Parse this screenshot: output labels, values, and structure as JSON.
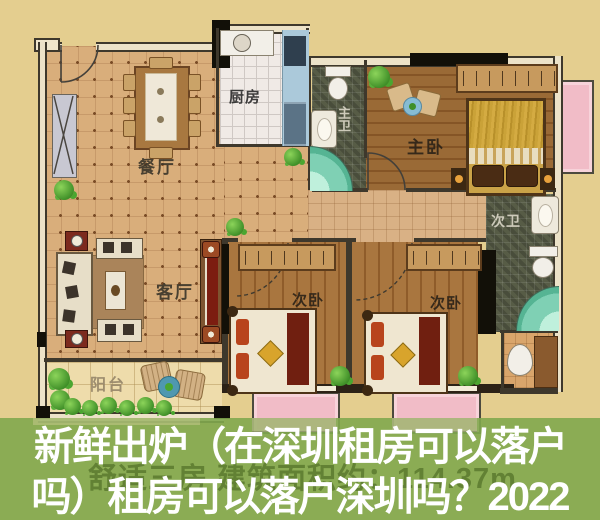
{
  "cover": {
    "title_line1": "新鲜出炉（在深圳租房可以落户",
    "title_line2": "吗）租房可以落户深圳吗？2022",
    "watermark": "舒适三房 建筑面积约：114.37m",
    "overlay_color": "#8fae58",
    "title_color": "#ffffff"
  },
  "floor_plan": {
    "rooms": {
      "dining": "餐厅",
      "kitchen": "厨房",
      "master_bath": "主卫",
      "master_bedroom": "主卧",
      "second_bath": "次卫",
      "living": "客厅",
      "bedroom_a": "次卧",
      "bedroom_b": "次卧",
      "balcony": "阳台"
    }
  }
}
